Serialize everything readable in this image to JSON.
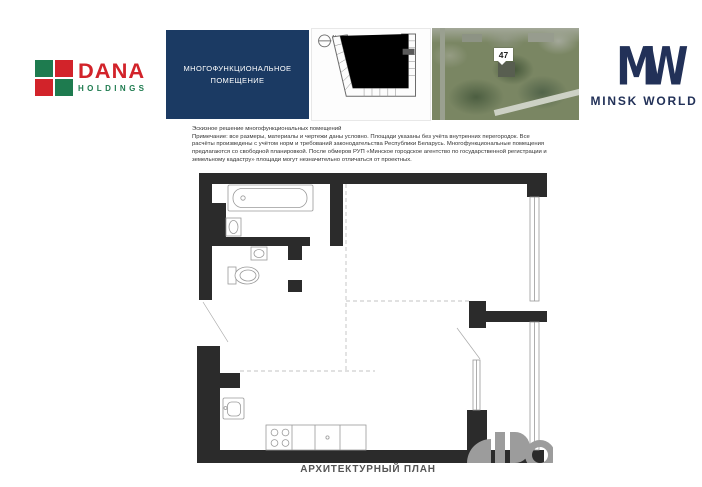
{
  "header": {
    "dana_logo": {
      "brand": "DANA",
      "subbrand": "HOLDINGS",
      "red": "#d2232a",
      "green": "#1e7b4f"
    },
    "unit_type_card": {
      "line1": "МНОГОФУНКЦИОНАЛЬНОЕ",
      "line2": "ПОМЕЩЕНИЕ",
      "bg_color": "#1b3a63"
    },
    "site_plan_card": {
      "north_label": "N"
    },
    "aerial_card": {
      "building_marker": "47"
    },
    "minsk_world_logo": {
      "monogram": "MW",
      "wordmark": "MINSK WORLD",
      "navy": "#223158"
    }
  },
  "disclaimer": {
    "title": "Эскизное решение многофункциональных помещений",
    "body": "Примечание: все размеры, материалы и чертежи даны условно. Площади указаны без учёта внутренних перегородок. Все расчёты произведены с учётом норм и требований законодательства Республики Беларусь. Многофункциональные помещения предлагаются со свободной планировкой. После обмеров РУП «Минское городское агентство по государственной регистрации и земельному кадастру» площади могут незначительно отличаться от проектных."
  },
  "floor_plan": {
    "caption": "АРХИТЕКТУРНЫЙ ПЛАН",
    "wall_color": "#2b2b2b"
  }
}
